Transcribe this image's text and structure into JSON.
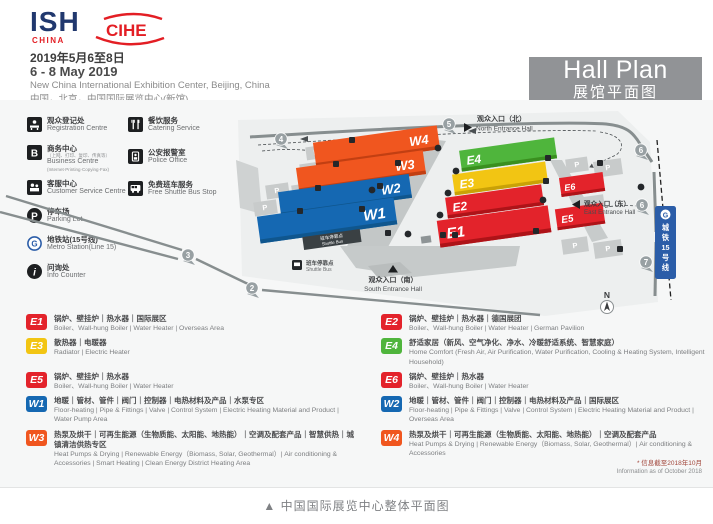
{
  "header": {
    "logo_ish": "ISH",
    "logo_ish_sub": "CHINA",
    "logo_cihe": "CIHE",
    "date_zh": "2019年5月6至8日",
    "date_en": "6 - 8 May 2019",
    "venue_en": "New China International Exhibition Center, Beijing, China",
    "venue_zh": "中国，北京，中国国际展览中心(新馆)",
    "plan_title_en": "Hall Plan",
    "plan_title_zh": "展馆平面图"
  },
  "facilities": {
    "left": [
      {
        "icon": "registration-icon",
        "zh": "观众登记处",
        "en": "Registration Centre"
      },
      {
        "icon": "business-icon",
        "zh": "商务中心",
        "zh_sub": "（上网、打印、复印、传真等）",
        "en": "Business Centre",
        "en_sub": "(Internet·Printing·Copying·Fax)"
      },
      {
        "icon": "customer-service-icon",
        "zh": "客服中心",
        "en": "Customer Service Centre"
      },
      {
        "icon": "parking-icon",
        "zh": "停车场",
        "en": "Parking Lot"
      },
      {
        "icon": "metro-icon",
        "zh": "地铁站(15号线)",
        "en": "Metro Station(Line 15)"
      },
      {
        "icon": "info-icon",
        "zh": "问询处",
        "en": "Info Counter"
      }
    ],
    "right": [
      {
        "icon": "catering-icon",
        "zh": "餐饮服务",
        "en": "Catering Service"
      },
      {
        "icon": "police-icon",
        "zh": "公安报警室",
        "en": "Police Office"
      },
      {
        "icon": "shuttle-icon",
        "zh": "免费班车服务",
        "en": "Free Shuttle Bus Stop"
      }
    ]
  },
  "map": {
    "hall_labels": {
      "W1": "W1",
      "W2": "W2",
      "W3": "W3",
      "W4": "W4",
      "E1": "E1",
      "E2": "E2",
      "E3": "E3",
      "E4": "E4",
      "E5": "E5",
      "E6": "E6"
    },
    "entrances": {
      "north_zh": "观众入口（北）",
      "north_en": "North Entrance Hall",
      "south_zh": "观众入口（南）",
      "south_en": "South Entrance Hall",
      "east_zh": "观众入口（东）",
      "east_en": "East Entrance Hall"
    },
    "shuttle_stop_zh": "班车停靠点",
    "shuttle_stop_en": "Shuttle Bus",
    "metro_chars": [
      "城",
      "铁",
      "15",
      "号",
      "线"
    ],
    "metro_logo_letter": "G",
    "markers": [
      "2",
      "3",
      "4",
      "5",
      "6",
      "6",
      "7"
    ],
    "parking_letter": "P",
    "compass_n": "N"
  },
  "colors": {
    "red": "#e3232b",
    "yellow": "#f2c513",
    "green": "#4fb53c",
    "blue": "#1568b2",
    "orange": "#f0561f",
    "gray_box": "#919396"
  },
  "hall_legend": {
    "E1": {
      "code": "E1",
      "zh": "锅炉、壁挂炉｜热水器｜国际展区",
      "en": "Boiler、Wall-hung Boiler | Water Heater | Overseas Area"
    },
    "E2": {
      "code": "E2",
      "zh": "锅炉、壁挂炉｜热水器｜德国展团",
      "en": "Boiler、Wall-hung Boiler | Water Heater | German Pavilion"
    },
    "E3": {
      "code": "E3",
      "zh": "散热器｜电暖器",
      "en": "Radiator | Electric Heater"
    },
    "E4": {
      "code": "E4",
      "zh": "舒适家居（新风、空气净化、净水、冷暖舒适系统、智慧家庭）",
      "en": "Home Comfort (Fresh Air, Air Purification, Water Purification, Cooling & Heating System, Intelligent Household)"
    },
    "E5": {
      "code": "E5",
      "zh": "锅炉、壁挂炉｜热水器",
      "en": "Boiler、Wall-hung Boiler | Water Heater"
    },
    "E6": {
      "code": "E6",
      "zh": "锅炉、壁挂炉｜热水器",
      "en": "Boiler、Wall-hung Boiler | Water Heater"
    },
    "W1": {
      "code": "W1",
      "zh": "地暖｜管材、管件｜阀门｜控制器｜电热材料及产品｜水泵专区",
      "en": "Floor-heating | Pipe & Fittings | Valve | Control System | Electric Heating Material and Product | Water Pump Area"
    },
    "W2": {
      "code": "W2",
      "zh": "地暖｜管材、管件｜阀门｜控制器｜电热材料及产品｜国际展区",
      "en": "Floor-heating | Pipe & Fittings | Valve | Control System | Electric Heating Material and Product | Overseas Area"
    },
    "W3": {
      "code": "W3",
      "zh": "热泵及烘干｜可再生能源（生物质能、太阳能、地热能）｜空调及配套产品｜智慧供热｜城镇清洁供热专区",
      "en": "Heat Pumps & Drying | Renewable Energy（Biomass, Solar, Geothermal）| Air conditioning & Accessories | Smart Heating | Clean Energy District Heating Area"
    },
    "W4": {
      "code": "W4",
      "zh": "热泵及烘干｜可再生能源（生物质能、太阳能、地热能）｜空调及配套产品",
      "en": "Heat Pumps & Drying | Renewable Energy（Biomass, Solar, Geothermal）| Air conditioning & Accessories"
    }
  },
  "footnote": {
    "zh": "* 信息截至2018年10月",
    "en": "Information as of October 2018"
  },
  "caption": "▲  中国国际展览中心整体平面图"
}
